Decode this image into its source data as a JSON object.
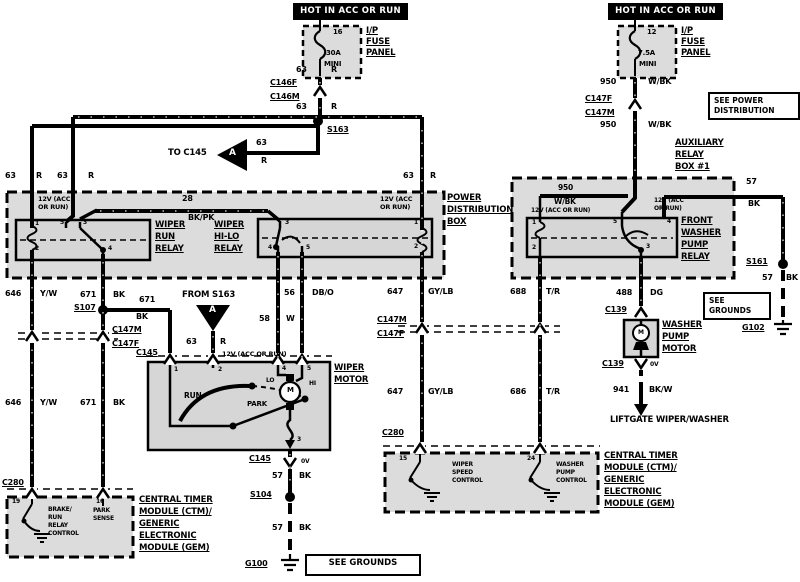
{
  "hot_left": "HOT IN ACC OR RUN",
  "hot_right": "HOT IN ACC OR RUN",
  "fuse_left": {
    "pin": "16",
    "rating": "30A",
    "size": "MINI",
    "panel1": "I/P",
    "panel2": "FUSE",
    "panel3": "PANEL"
  },
  "fuse_right": {
    "pin": "12",
    "rating": "7.5A",
    "size": "MINI",
    "panel1": "I/P",
    "panel2": "FUSE",
    "panel3": "PANEL"
  },
  "w": {
    "n63": "63",
    "r": "R",
    "n950": "950",
    "wbk": "W/BK",
    "n28": "28",
    "bkpk": "BK/PK",
    "n57": "57",
    "bk": "BK",
    "n646": "646",
    "yw": "Y/W",
    "n671": "671",
    "n56": "56",
    "dbo": "DB/O",
    "n58": "58",
    "wht": "W",
    "n647": "647",
    "gylb": "GY/LB",
    "n688": "688",
    "n686": "686",
    "tr": "T/R",
    "n488": "488",
    "dg": "DG",
    "n941": "941",
    "bkw": "BK/W"
  },
  "conn": {
    "c146f": "C146F",
    "c146m": "C146M",
    "c147f": "C147F",
    "c147m": "C147M",
    "c145": "C145",
    "c280": "C280",
    "c139": "C139"
  },
  "splice": {
    "s163": "S163",
    "s107": "S107",
    "s104": "S104",
    "s161": "S161"
  },
  "gnd": {
    "g100": "G100",
    "g102": "G102"
  },
  "note": {
    "see_power1": "SEE POWER",
    "see_power2": "DISTRIBUTION",
    "see_grounds": "SEE GROUNDS",
    "see_grounds1": "SEE",
    "see_grounds2": "GROUNDS",
    "to_c145": "TO C145",
    "from_s163": "FROM S163",
    "tri": "A",
    "liftgate": "LIFTGATE WIPER/WASHER",
    "v12": "12V (ACC OR RUN)",
    "v12a": "12V (ACC",
    "v12b": "OR RUN)",
    "v0": "0V"
  },
  "pdb": {
    "l1": "POWER",
    "l2": "DISTRIBUTION",
    "l3": "BOX"
  },
  "aux": {
    "l1": "AUXILIARY",
    "l2": "RELAY",
    "l3": "BOX #1"
  },
  "relay_run": {
    "l1": "WIPER",
    "l2": "RUN",
    "l3": "RELAY"
  },
  "relay_hilo": {
    "l1": "WIPER",
    "l2": "HI-LO",
    "l3": "RELAY"
  },
  "relay_washer": {
    "l1": "FRONT",
    "l2": "WASHER",
    "l3": "PUMP",
    "l4": "RELAY"
  },
  "motor": {
    "l1": "WIPER",
    "l2": "MOTOR",
    "run": "RUN",
    "park": "PARK",
    "lo": "LO",
    "hi": "HI",
    "m": "M"
  },
  "washer_motor": {
    "l1": "WASHER",
    "l2": "PUMP",
    "l3": "MOTOR",
    "m": "M"
  },
  "ctm": {
    "l1": "CENTRAL TIMER",
    "l2": "MODULE (CTM)/",
    "l3": "GENERIC",
    "l4": "ELECTRONIC",
    "l5": "MODULE (GEM)"
  },
  "sig": {
    "brake1": "BRAKE/",
    "brake2": "RUN",
    "brake3": "RELAY",
    "brake4": "CONTROL",
    "park1": "PARK",
    "park2": "SENSE",
    "speed1": "WIPER",
    "speed2": "SPEED",
    "speed3": "CONTROL",
    "wash1": "WASHER",
    "wash2": "PUMP",
    "wash3": "CONTROL"
  },
  "pins": {
    "p1": "1",
    "p2": "2",
    "p3": "3",
    "p4": "4",
    "p5": "5",
    "p15": "15",
    "p16": "16",
    "p19": "19",
    "p24": "24"
  }
}
